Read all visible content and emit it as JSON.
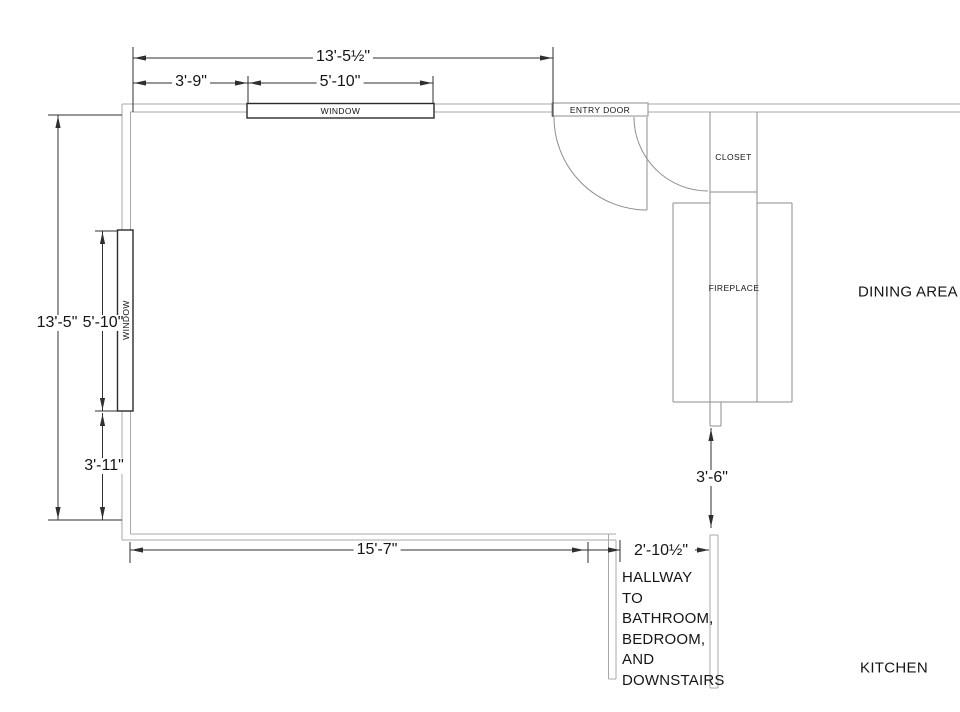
{
  "plan": {
    "labels": {
      "window_top": "WINDOW",
      "entry_door": "ENTRY DOOR",
      "closet": "CLOSET",
      "fireplace": "FIREPLACE",
      "window_left": "WINDOW",
      "dining_area": "DINING AREA",
      "kitchen": "KITCHEN"
    },
    "hallway": {
      "lines": [
        "HALLWAY",
        "TO",
        "BATHROOM,",
        "BEDROOM,",
        "AND",
        "DOWNSTAIRS"
      ]
    },
    "dimensions": {
      "top_total": "13'-5½\"",
      "top_left_segment": "3'-9\"",
      "top_window": "5'-10\"",
      "left_total": "13'-5\"",
      "left_window": "5'-10\"",
      "left_below_window": "3'-11\"",
      "bottom_wall": "15'-7\"",
      "hallway_width": "2'-10½\"",
      "fireplace_to_hallway": "3'-6\""
    },
    "colors": {
      "wall": "#a8a8a8",
      "feature": "#8e8e8e",
      "window": "#2b2b2b",
      "dimension": "#2f2f2f",
      "background": "#ffffff"
    }
  }
}
